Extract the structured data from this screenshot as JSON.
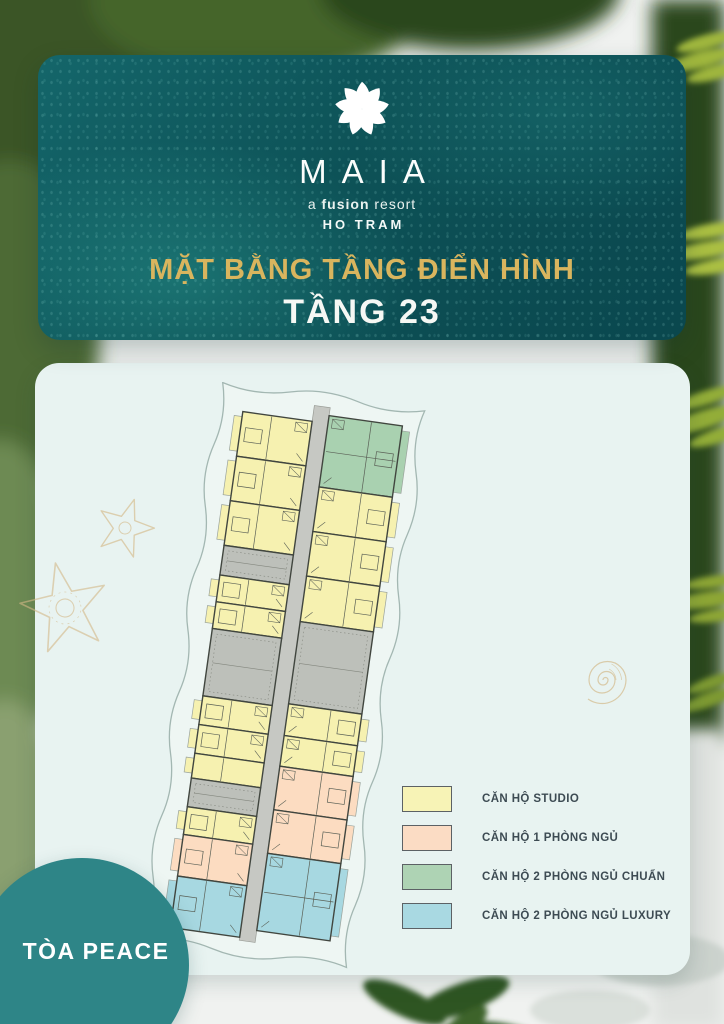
{
  "header": {
    "brand": "MAIA",
    "brand_sub_pre": "a ",
    "brand_sub_em": "fusion",
    "brand_sub_post": " resort",
    "location": "HO TRAM",
    "title": "MẶT BẰNG TẦNG ĐIỂN HÌNH",
    "subtitle": "TẦNG 23",
    "card_color": "#0d5257",
    "title_color": "#d9b55e"
  },
  "badge": {
    "label": "TÒA PEACE",
    "color": "#2e8587"
  },
  "legend": {
    "items": [
      {
        "label": "CĂN HỘ STUDIO",
        "color": "#f7f3b6"
      },
      {
        "label": "CĂN HỘ 1 PHÒNG NGỦ",
        "color": "#fbdcc4"
      },
      {
        "label": "CĂN HỘ 2 PHÒNG NGỦ CHUẨN",
        "color": "#aed3b4"
      },
      {
        "label": "CĂN HỘ 2 PHÒNG NGỦ LUXURY",
        "color": "#a9d9e2"
      }
    ]
  },
  "floorplan": {
    "rotation_deg": 8,
    "outline_color": "#a3b7b2",
    "outline_fill": "#eef6f3",
    "corridor_color": "#c6c8c3",
    "wall_color": "#41463f",
    "detail_color": "#5a6056",
    "unit_colors": {
      "studio": "#f6f1b0",
      "one_bed": "#fcdcc1",
      "two_bed_std": "#a9d1b0",
      "two_bed_lux": "#a7d8e1",
      "core": "#bdc0ba"
    },
    "left_start": 8,
    "right_start": 0,
    "left_rows": [
      {
        "type": "studio",
        "h": 45
      },
      {
        "type": "studio",
        "h": 45
      },
      {
        "type": "studio",
        "h": 45
      },
      {
        "type": "core",
        "h": 30
      },
      {
        "type": "studio",
        "h": 27
      },
      {
        "type": "studio",
        "h": 27
      },
      {
        "type": "core",
        "h": 68
      },
      {
        "type": "studio",
        "h": 29
      },
      {
        "type": "studio",
        "h": 29
      },
      {
        "type": "studio",
        "h": 25
      },
      {
        "type": "core",
        "h": 29
      },
      {
        "type": "studio",
        "h": 28
      },
      {
        "type": "one_bed",
        "h": 42
      },
      {
        "type": "two_bed_lux",
        "h": 52
      }
    ],
    "right_rows": [
      {
        "type": "two_bed_std",
        "h": 72
      },
      {
        "type": "studio",
        "h": 45
      },
      {
        "type": "studio",
        "h": 45
      },
      {
        "type": "studio",
        "h": 46
      },
      {
        "type": "core",
        "h": 83
      },
      {
        "type": "studio",
        "h": 32
      },
      {
        "type": "studio",
        "h": 31
      },
      {
        "type": "one_bed",
        "h": 44
      },
      {
        "type": "one_bed",
        "h": 44
      },
      {
        "type": "two_bed_lux",
        "h": 78
      }
    ]
  },
  "decorations": {
    "gold_color": "#d5bb8b"
  }
}
